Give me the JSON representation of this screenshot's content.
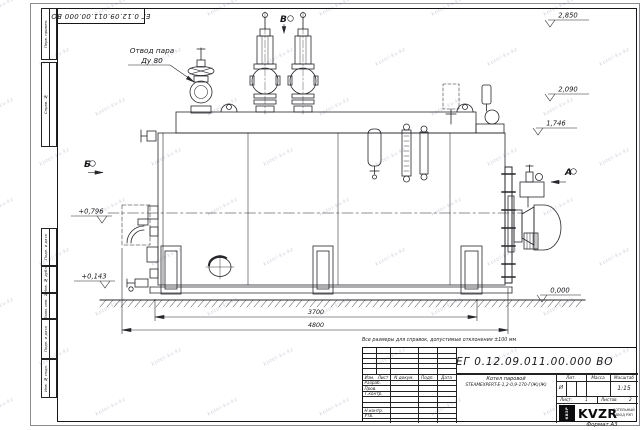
{
  "watermark": {
    "text": "kotel-kv.kz"
  },
  "sheet": {
    "doc_number": "ЕГ 0.12.09.011.00.000  ВО",
    "format_note": "Формат А3",
    "margin_labels_top": [
      "Перв. примен.",
      "Справ. №"
    ],
    "margin_labels_bottom": [
      "Подп. и дата",
      "Инв. № дубл.",
      "Взам. инв. №",
      "Подп. и дата",
      "Инв. № подл."
    ]
  },
  "drawing": {
    "callout": {
      "line1": "Отвод пара",
      "line2": "Ду 80"
    },
    "views": {
      "a": "А",
      "b": "Б",
      "v": "В"
    },
    "elevations": [
      "2,850",
      "2,090",
      "1,746",
      "0,000",
      "+0,796",
      "+0,143"
    ],
    "dimensions": [
      "3700",
      "4800"
    ]
  },
  "title_block": {
    "note": "Все размеры для справок, допустимые отклонения ±100 мм",
    "doc_number": "ЕГ 0.12.09.011.00.000  ВО",
    "change_cols": [
      "Изм.",
      "Лист",
      "N докум.",
      "Подп.",
      "Дата"
    ],
    "role_rows": [
      "Разраб.",
      "Пров.",
      "Т.контр.",
      "Н.контр.",
      "Утв."
    ],
    "product_line1": "Котел паровой",
    "product_line2": "STEAMEXPERT-Е-1,2-0,9-170-Г(Ж)(Ж)",
    "lit_label": "Лит.",
    "lit_value": "И",
    "mass_label": "Масса",
    "scale_label": "Масштаб",
    "scale_value": "1:15",
    "sheet_label": "Лист",
    "sheet_value": "1",
    "sheets_label": "Листов",
    "sheets_value": "2",
    "brand": {
      "badge": "КВЗР",
      "name": "KVZR",
      "tagline1": "КОТЕЛЬНЫЙ",
      "tagline2": "ЗАВОД РЭП"
    }
  }
}
